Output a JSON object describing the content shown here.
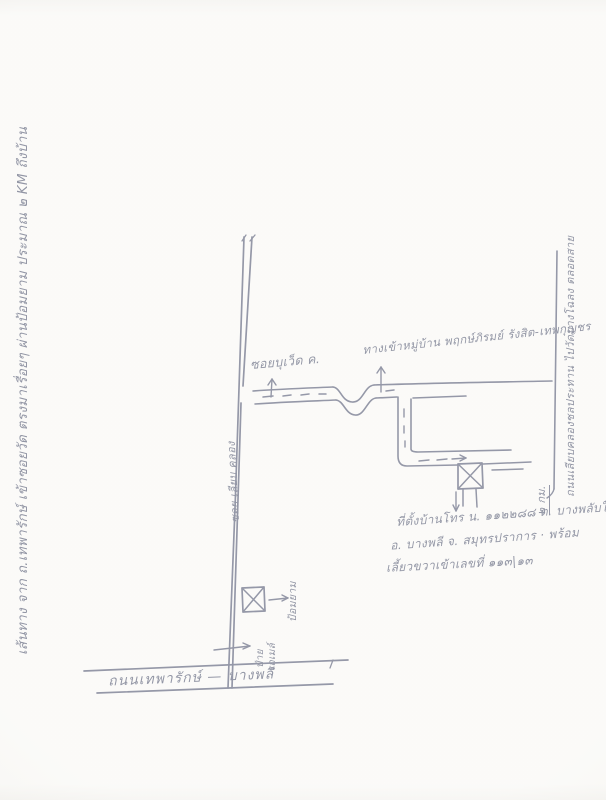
{
  "document": {
    "kind": "hand-drawn route sketch map (scanned, handwritten Thai ink)",
    "ink_color": "#2b3150",
    "paper_color": "#f7f6f2"
  },
  "labels": {
    "left_margin_note": "เส้นทาง จาก ถ.เทพารักษ์ เข้าซอยวัด ตรงมาเรื่อยๆ ผ่านป้อมยาม ประมาณ ๒ KM ถึงบ้าน",
    "soi_label": "ซอยบุเว็ด ค.",
    "village_entrance": "ทางเข้าหมู่บ้าน พฤกษ์ภิรมย์ รังสิต-เทพกุญชร",
    "vertical_road_name": "ซอย เลียบ คลอง",
    "right_road_note": "ถนนเลียบคลองชลประทาน ไปวัดบางโฉลง ตลอดสาย",
    "right_road_distance": "๒ กม.",
    "address_line1": "ที่ตั้งบ้านโทร น. ๑๑๒๒๘๘ ต. บางพลับใหญ่",
    "address_line2": "อ. บางพลี จ. สมุทรปราการ · พร้อม",
    "address_line3": "เลี้ยวขวาเข้าเลขที่ ๑๑๓|๑๓",
    "guardhouse_label": "ป้อมยาม",
    "bus_stop_line1": "ป้าย",
    "bus_stop_line2": "รถเมล์",
    "bottom_road_name": "ถนนเทพารักษ์ — บางพลี"
  }
}
